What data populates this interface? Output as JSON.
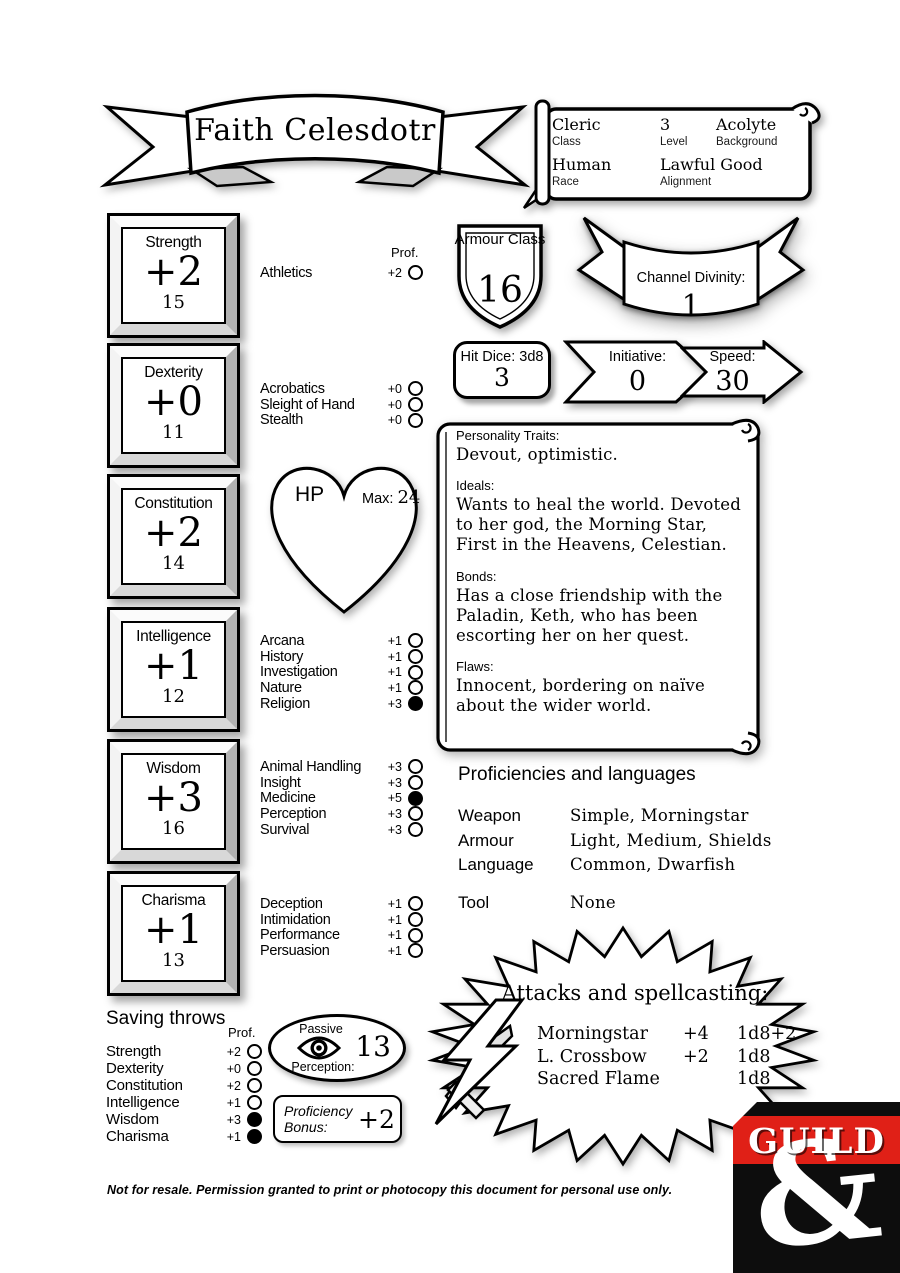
{
  "banner": {
    "name": "Faith Celesdotr"
  },
  "header": {
    "class_value": "Cleric",
    "class_label": "Class",
    "level_value": "3",
    "level_label": "Level",
    "background_value": "Acolyte",
    "background_label": "Background",
    "race_value": "Human",
    "race_label": "Race",
    "alignment_value": "Lawful Good",
    "alignment_label": "Alignment"
  },
  "abilities": [
    {
      "name": "Strength",
      "mod": "+2",
      "score": "15"
    },
    {
      "name": "Dexterity",
      "mod": "+0",
      "score": "11"
    },
    {
      "name": "Constitution",
      "mod": "+2",
      "score": "14"
    },
    {
      "name": "Intelligence",
      "mod": "+1",
      "score": "12"
    },
    {
      "name": "Wisdom",
      "mod": "+3",
      "score": "16"
    },
    {
      "name": "Charisma",
      "mod": "+1",
      "score": "13"
    }
  ],
  "skills": {
    "prof_label": "Prof.",
    "strength": [
      {
        "name": "Athletics",
        "mod": "+2",
        "prof": false
      }
    ],
    "dexterity": [
      {
        "name": "Acrobatics",
        "mod": "+0",
        "prof": false
      },
      {
        "name": "Sleight of Hand",
        "mod": "+0",
        "prof": false
      },
      {
        "name": "Stealth",
        "mod": "+0",
        "prof": false
      }
    ],
    "intelligence": [
      {
        "name": "Arcana",
        "mod": "+1",
        "prof": false
      },
      {
        "name": "History",
        "mod": "+1",
        "prof": false
      },
      {
        "name": "Investigation",
        "mod": "+1",
        "prof": false
      },
      {
        "name": "Nature",
        "mod": "+1",
        "prof": false
      },
      {
        "name": "Religion",
        "mod": "+3",
        "prof": true
      }
    ],
    "wisdom": [
      {
        "name": "Animal Handling",
        "mod": "+3",
        "prof": false
      },
      {
        "name": "Insight",
        "mod": "+3",
        "prof": false
      },
      {
        "name": "Medicine",
        "mod": "+5",
        "prof": true
      },
      {
        "name": "Perception",
        "mod": "+3",
        "prof": false
      },
      {
        "name": "Survival",
        "mod": "+3",
        "prof": false
      }
    ],
    "charisma": [
      {
        "name": "Deception",
        "mod": "+1",
        "prof": false
      },
      {
        "name": "Intimidation",
        "mod": "+1",
        "prof": false
      },
      {
        "name": "Performance",
        "mod": "+1",
        "prof": false
      },
      {
        "name": "Persuasion",
        "mod": "+1",
        "prof": false
      }
    ]
  },
  "combat": {
    "armour_class_label": "Armour Class",
    "armour_class": "16",
    "channel_divinity_label": "Channel Divinity:",
    "channel_divinity": "1",
    "hit_dice_label": "Hit Dice: 3d8",
    "hit_dice": "3",
    "initiative_label": "Initiative:",
    "initiative": "0",
    "speed_label": "Speed:",
    "speed": "30",
    "hp_label": "HP",
    "hp_max_label": "Max:",
    "hp_max": "24"
  },
  "personality": {
    "traits_label": "Personality Traits:",
    "traits": "Devout, optimistic.",
    "ideals_label": "Ideals:",
    "ideals": "Wants to heal the world. Devoted to her god, the Morning Star, First in the Heavens, Celestian.",
    "bonds_label": "Bonds:",
    "bonds": "Has a close friendship with the Paladin, Keth, who has been escorting her on her quest.",
    "flaws_label": "Flaws:",
    "flaws": "Innocent, bordering on naïve about the wider world."
  },
  "proficiencies": {
    "title": "Proficiencies and languages",
    "rows": [
      {
        "label": "Weapon",
        "value": "Simple, Morningstar"
      },
      {
        "label": "Armour",
        "value": "Light, Medium, Shields"
      },
      {
        "label": "Language",
        "value": "Common, Dwarfish"
      },
      {
        "label": "Tool",
        "value": "None"
      }
    ]
  },
  "attacks": {
    "title": "Attacks and spellcasting:",
    "rows": [
      {
        "name": "Morningstar",
        "bonus": "+4",
        "damage": "1d8+2"
      },
      {
        "name": "L. Crossbow",
        "bonus": "+2",
        "damage": "1d8"
      },
      {
        "name": "Sacred Flame",
        "bonus": "",
        "damage": "1d8"
      }
    ]
  },
  "saving_throws": {
    "title": "Saving throws",
    "prof_label": "Prof.",
    "rows": [
      {
        "name": "Strength",
        "mod": "+2",
        "prof": false
      },
      {
        "name": "Dexterity",
        "mod": "+0",
        "prof": false
      },
      {
        "name": "Constitution",
        "mod": "+2",
        "prof": false
      },
      {
        "name": "Intelligence",
        "mod": "+1",
        "prof": false
      },
      {
        "name": "Wisdom",
        "mod": "+3",
        "prof": true
      },
      {
        "name": "Charisma",
        "mod": "+1",
        "prof": true
      }
    ]
  },
  "passive_perception": {
    "label_top": "Passive",
    "label_bottom": "Perception:",
    "value": "13"
  },
  "proficiency_bonus": {
    "label": "Proficiency Bonus:",
    "value": "+2"
  },
  "footer": {
    "text": "Not for resale. Permission granted to print or photocopy this document for personal use only."
  },
  "logo": {
    "text": "GUILD",
    "ampersand": "&",
    "red": "#e02017"
  }
}
